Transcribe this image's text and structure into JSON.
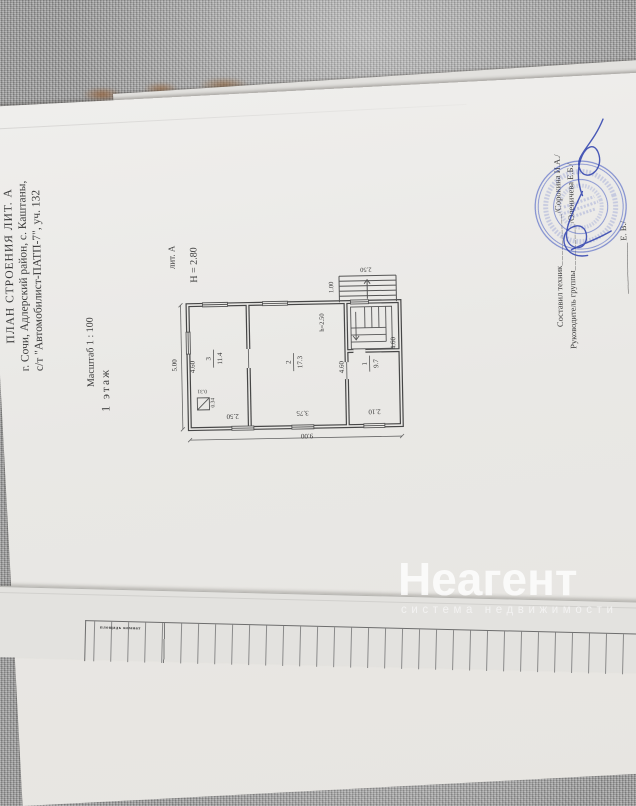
{
  "watermark": {
    "brand": "Неагент",
    "tagline": "система недвижимости"
  },
  "document": {
    "title_block": {
      "line1": "ПЛАН СТРОЕНИЯ ЛИТ. А",
      "line2": "г. Сочи, Адлерский район, с. Каштаны,",
      "line3": "с/т \"Автомобилист-ПАТП-7\", уч. 132",
      "scale": "Масштаб 1 : 100",
      "floor_label": "1 этаж"
    },
    "plan": {
      "litera": "лит. А",
      "building_height": "Н = 2.80",
      "stair_clearance": "h=2.50",
      "rooms": [
        {
          "number": "1",
          "area": "9.7"
        },
        {
          "number": "2",
          "area": "17.3"
        },
        {
          "number": "3",
          "area": "11.4"
        }
      ],
      "dims": {
        "total_width": "9.00",
        "total_depth": "5.00",
        "room1_width": "2.10",
        "room2_width": "3.75",
        "room3_width": "2.50",
        "room_depth": "4.60",
        "porch_width": "2.50",
        "porch_depth": "1.00",
        "stove_w": "0.34",
        "stove_h": "0.31"
      }
    },
    "signatures": {
      "line1_role": "Составил техник",
      "line1_sep": "__________",
      "line1_name": "/Сорокина И.А./",
      "line2_role": "Руководитель группы",
      "line2_sep": "_________",
      "line2_name": "/Оленичева Е.Б./",
      "line3_fragment": "____________ Е. В./"
    },
    "bottom_table": {
      "cell1": "площадь комнат"
    }
  },
  "colors": {
    "stamp_blue": "#3d54c0",
    "ink_blue": "#2c3fae",
    "paper": "#ebeae7",
    "fabric": "#9e9e9e"
  }
}
